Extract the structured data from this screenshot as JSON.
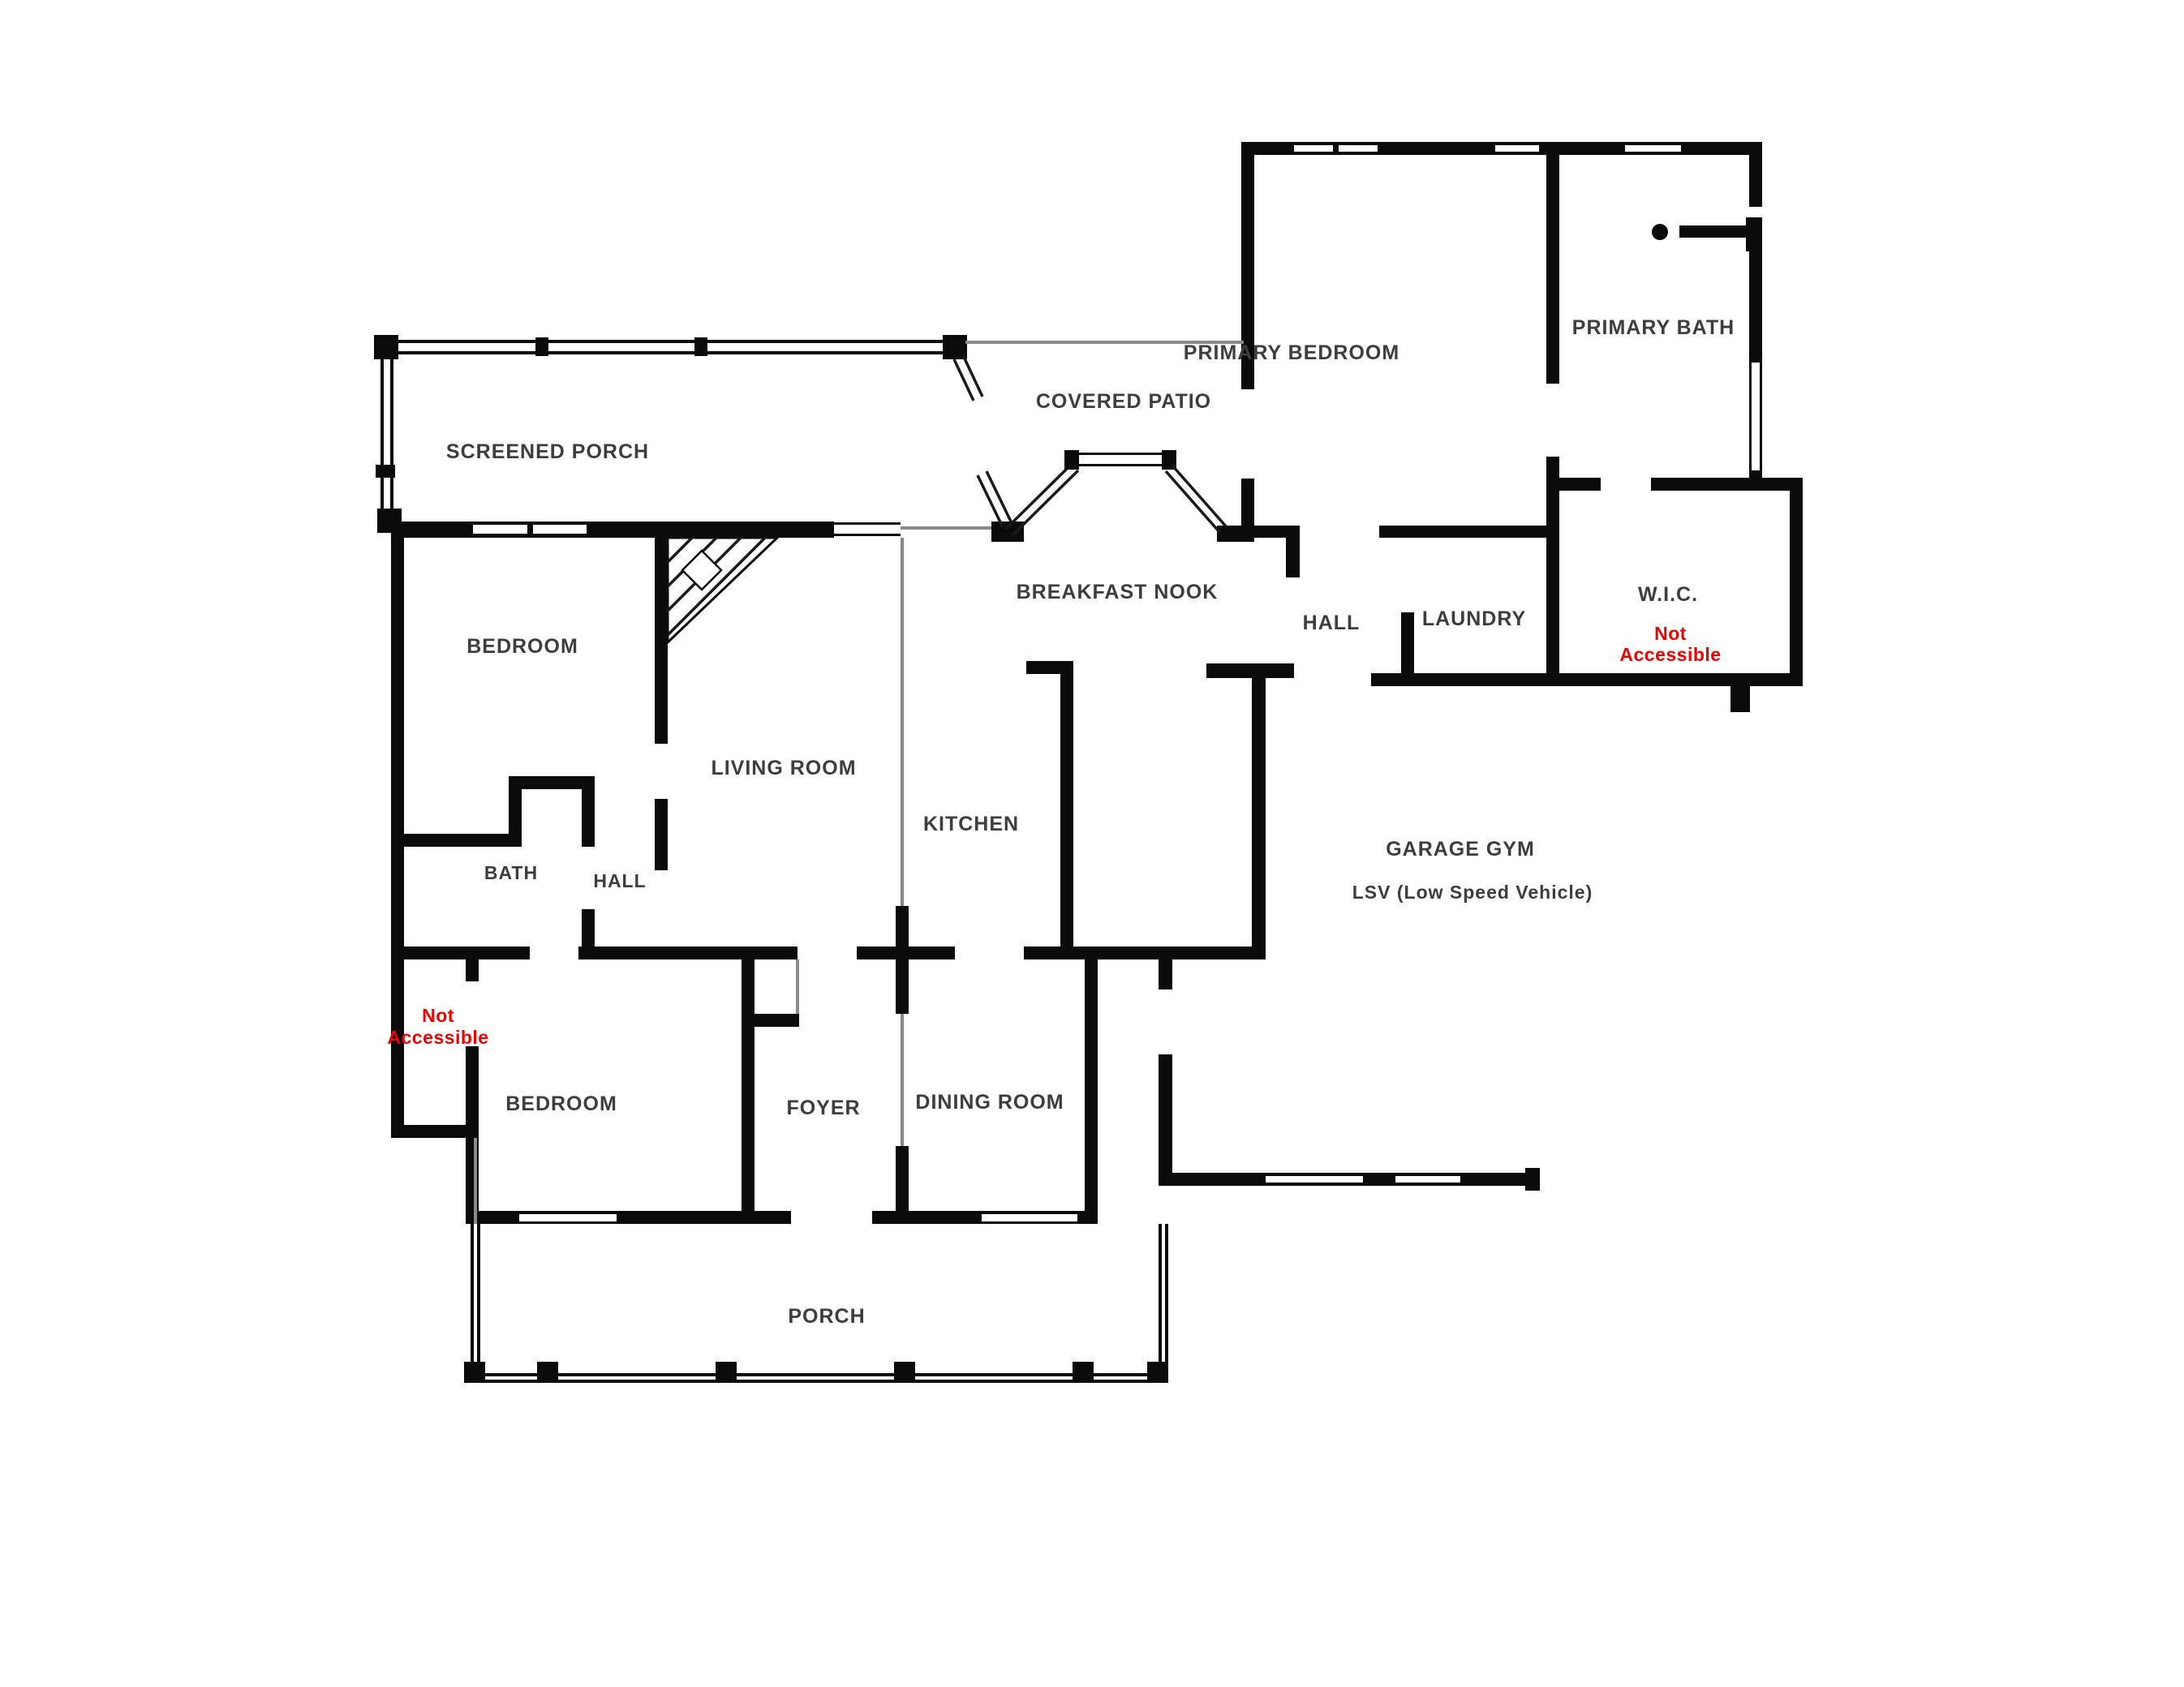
{
  "document": {
    "type": "residential-floor-plan",
    "background": "#ffffff"
  },
  "colors": {
    "wall": "#0a0a0a",
    "room_label": "#3d3d3d",
    "not_accessible_red": "#ee0000",
    "thin_feature_gray": "#8a8a8a"
  },
  "rooms": [
    {
      "id": "screened-porch",
      "label": "SCREENED PORCH"
    },
    {
      "id": "covered-patio",
      "label": "COVERED PATIO"
    },
    {
      "id": "primary-bedroom",
      "label": "PRIMARY BEDROOM"
    },
    {
      "id": "primary-bath",
      "label": "PRIMARY BATH"
    },
    {
      "id": "breakfast-nook",
      "label": "BREAKFAST NOOK"
    },
    {
      "id": "hall-upper",
      "label": "HALL"
    },
    {
      "id": "laundry",
      "label": "LAUNDRY"
    },
    {
      "id": "wic",
      "label": "W.I.C."
    },
    {
      "id": "bedroom-left",
      "label": "BEDROOM"
    },
    {
      "id": "living-room",
      "label": "LIVING ROOM"
    },
    {
      "id": "kitchen",
      "label": "KITCHEN"
    },
    {
      "id": "bath",
      "label": "BATH"
    },
    {
      "id": "hall-lower",
      "label": "HALL"
    },
    {
      "id": "garage-gym",
      "label": "GARAGE GYM"
    },
    {
      "id": "garage-gym-sub",
      "label": "LSV (Low Speed Vehicle)"
    },
    {
      "id": "bedroom-bottom",
      "label": "BEDROOM"
    },
    {
      "id": "foyer",
      "label": "FOYER"
    },
    {
      "id": "dining-room",
      "label": "DINING ROOM"
    },
    {
      "id": "porch",
      "label": "PORCH"
    }
  ],
  "annotations": [
    {
      "id": "wic-not-accessible",
      "line1": "Not",
      "line2": "Accessible",
      "color": "#ee0000"
    },
    {
      "id": "left-not-accessible",
      "line1": "Not",
      "line2": "Accessible",
      "color": "#ee0000"
    }
  ]
}
